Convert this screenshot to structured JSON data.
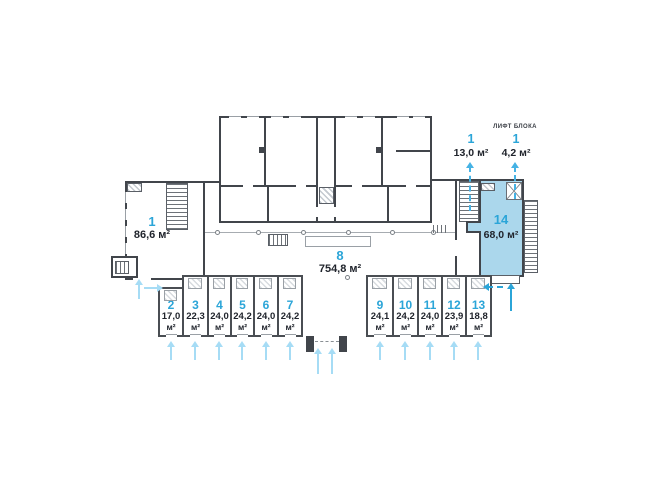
{
  "colors": {
    "accent_blue": "#2BA5D8",
    "highlight_fill": "#ABD7EC",
    "light_arrow": "#A6DCF5",
    "wall_dark": "#41454B",
    "area_text": "#20242C"
  },
  "labels": {
    "lift_block": "ЛИФТ БЛОКА"
  },
  "units": {
    "room1": {
      "number": "1",
      "area": "86,6",
      "unit": "м²"
    },
    "room8": {
      "number": "8",
      "area": "754,8",
      "unit": "м²"
    },
    "room14": {
      "number": "14",
      "area": "68,0",
      "unit": "м²"
    },
    "stair13": {
      "number": "1",
      "area": "13,0",
      "unit": "м²"
    },
    "lift42": {
      "number": "1",
      "area": "4,2",
      "unit": "м²"
    },
    "small_left": [
      {
        "number": "2",
        "area": "17,0",
        "unit": "м²"
      },
      {
        "number": "3",
        "area": "22,3",
        "unit": "м²"
      },
      {
        "number": "4",
        "area": "24,0",
        "unit": "м²"
      },
      {
        "number": "5",
        "area": "24,2",
        "unit": "м²"
      },
      {
        "number": "6",
        "area": "24,0",
        "unit": "м²"
      },
      {
        "number": "7",
        "area": "24,2",
        "unit": "м²"
      }
    ],
    "small_right": [
      {
        "number": "9",
        "area": "24,1",
        "unit": "м²"
      },
      {
        "number": "10",
        "area": "24,2",
        "unit": "м²"
      },
      {
        "number": "11",
        "area": "24,0",
        "unit": "м²"
      },
      {
        "number": "12",
        "area": "23,9",
        "unit": "м²"
      },
      {
        "number": "13",
        "area": "18,8",
        "unit": "м²"
      }
    ]
  }
}
